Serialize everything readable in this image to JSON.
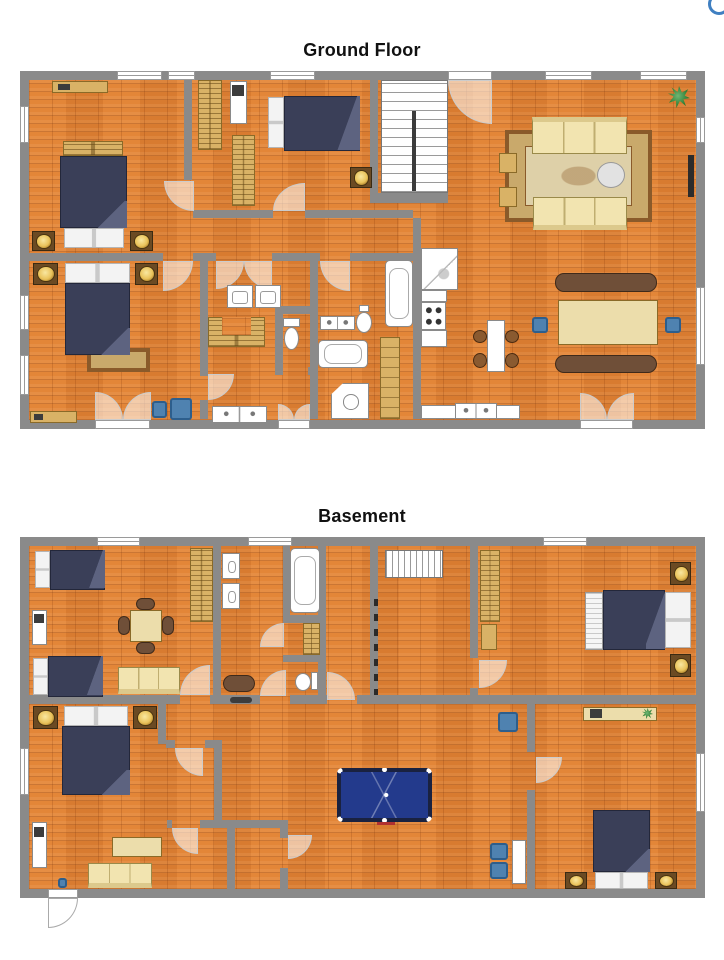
{
  "page": {
    "background": "#ffffff"
  },
  "logo": {
    "name": "corner-logo"
  },
  "floors": [
    {
      "title": "Ground Floor",
      "rooms": [
        {
          "name": "bedroom-top-left",
          "furniture": [
            "double bed",
            "two nightstands with lamps",
            "rattan bench",
            "sideboard"
          ]
        },
        {
          "name": "bedroom-top-middle",
          "furniture": [
            "double bed",
            "nightstand with lamp",
            "two wardrobes",
            "desk with chair"
          ]
        },
        {
          "name": "bedroom-bottom-left",
          "furniture": [
            "double bed",
            "two nightstands with lamps",
            "rug",
            "sideboard",
            "two blue chairs"
          ]
        },
        {
          "name": "stair-hall",
          "furniture": [
            "staircase"
          ]
        },
        {
          "name": "laundry-room",
          "furniture": [
            "washer",
            "dryer",
            "built-in desk",
            "double sink"
          ]
        },
        {
          "name": "wc",
          "furniture": [
            "toilet"
          ]
        },
        {
          "name": "bathroom",
          "furniture": [
            "double sink",
            "toilet",
            "bathtub",
            "corner shower",
            "large bathtub",
            "tall cabinet"
          ]
        },
        {
          "name": "kitchen",
          "furniture": [
            "corner sink unit",
            "stove",
            "counters",
            "sink counter"
          ]
        },
        {
          "name": "dining-area",
          "furniture": [
            "large table",
            "two benches",
            "two blue chairs",
            "small table",
            "four stools"
          ]
        },
        {
          "name": "living-room",
          "furniture": [
            "two sofas",
            "two armchairs",
            "round table",
            "ornate rug",
            "potted plant",
            "fireplace"
          ]
        }
      ]
    },
    {
      "title": "Basement",
      "rooms": [
        {
          "name": "family-room",
          "furniture": [
            "two single beds",
            "square table with four chairs",
            "sofa",
            "wardrobe",
            "desk"
          ]
        },
        {
          "name": "bathroom",
          "furniture": [
            "two sinks",
            "bathtub",
            "cabinet",
            "toilet",
            "mat"
          ]
        },
        {
          "name": "stair-hall",
          "furniture": [
            "staircase",
            "wall shelving"
          ]
        },
        {
          "name": "bedroom-top-right",
          "furniture": [
            "double bed",
            "two nightstands with lamps",
            "wardrobe",
            "cabinet",
            "bench"
          ]
        },
        {
          "name": "bedroom-bottom-left",
          "furniture": [
            "double bed",
            "two nightstands with lamps",
            "dresser",
            "sofa",
            "desk"
          ]
        },
        {
          "name": "game-room",
          "furniture": [
            "pool table",
            "three blue chairs",
            "side table"
          ]
        },
        {
          "name": "bedroom-bottom-right",
          "furniture": [
            "double bed",
            "two nightstands with lamps",
            "desk with laptop"
          ]
        },
        {
          "name": "closets",
          "furniture": []
        }
      ]
    }
  ],
  "colors": {
    "title": "#111111",
    "wall": "#8a8a8a",
    "floor_base": "#e08134",
    "window_frame": "#9a9a9a",
    "bed": "#3a3f58",
    "bed_border": "#23273a",
    "bed_fold": "#5d6380",
    "nightstand": "#6b4a23",
    "lamp": "#e9c25a",
    "lamp_dark": "#8a5a10",
    "sofa": "#f2e4b0",
    "sofa_border": "#9a8a4a",
    "wood": "#d9b266",
    "wood_line": "#8a6a28",
    "table_light": "#ecddab",
    "stool_brown": "#8a5a30",
    "bench_brown": "#6f4f38",
    "chair_blue": "#4f82b0",
    "chair_blue_dark": "#2d5e8c",
    "rug_border": "#8a5a2a",
    "rug_mid": "#c9a96b",
    "rug_center": "#ded0a8",
    "pool_border": "#1a2240",
    "pool_bed": "#233a8c",
    "plant": "#2f7d32",
    "fixture_border": "#8a8a8a",
    "fireplace": "#2b2b2b",
    "arc_fill": "rgba(255,255,255,0.55)",
    "arc_border": "#cccccc",
    "logo": "#3f7fc1"
  }
}
